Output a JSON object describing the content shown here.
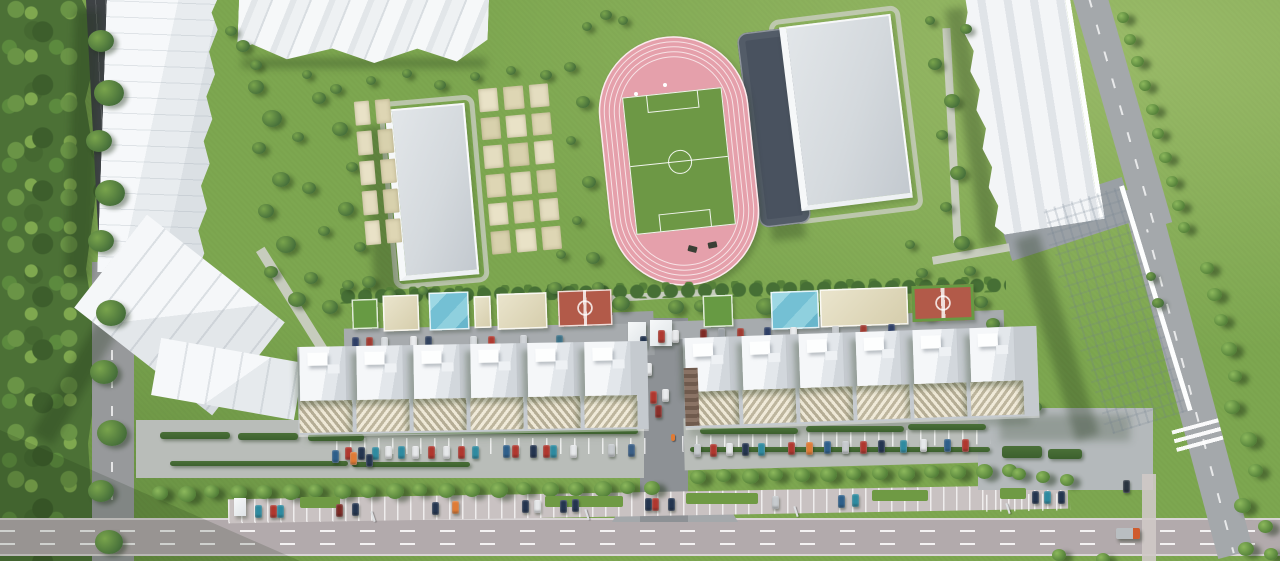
{
  "scene": {
    "width": 1280,
    "height": 561,
    "description": "Aerial 3D render of a residential complex masterplan: forest edge, apartment slabs, garden plots, school building, pink athletics stadium with soccer field, gray sports hall, courtyard playgrounds, tree-lined parking rows and roads"
  },
  "palette": {
    "lawn": "#7da750",
    "forest": "#4c7136",
    "roadDark": "#3e4245",
    "road": "#97999b",
    "roadMain": "#b2aaac",
    "roadLight": "#a4a8ab",
    "parkingLot": "#b9bdb9",
    "parkingStreet": "#c9c2c2",
    "path": "#cfd0ca",
    "building": "#f3f5f7",
    "slab": "#c5cacf",
    "track": "#e5a0ab",
    "field": "#6d9845",
    "darkCourt": "#49525f",
    "beige": "#e2dab8",
    "poolBlue": "#74c0d4",
    "redCourt": "#b25a49",
    "hedge": "#426834"
  },
  "sprites": {
    "courts": [
      [
        352,
        299,
        26,
        30,
        "c-green"
      ],
      [
        383,
        295,
        36,
        36,
        "c-beige"
      ],
      [
        429,
        292,
        40,
        38,
        "c-blue"
      ],
      [
        474,
        296,
        17,
        32,
        "c-beige"
      ],
      [
        497,
        293,
        50,
        36,
        "c-beige"
      ],
      [
        558,
        290,
        54,
        36,
        "c-red"
      ],
      [
        703,
        295,
        30,
        32,
        "c-green"
      ],
      [
        771,
        291,
        48,
        38,
        "c-blue"
      ],
      [
        820,
        288,
        88,
        38,
        "c-beige"
      ],
      [
        912,
        285,
        62,
        36,
        "c-red2"
      ]
    ],
    "gardens": [
      [
        483,
        84,
        74,
        170,
        -5,
        3,
        6
      ],
      [
        358,
        98,
        40,
        148,
        -5,
        2,
        5
      ]
    ],
    "midband": [
      [
        298,
        344,
        350,
        88,
        -1,
        6,
        57,
        46,
        0
      ],
      [
        684,
        332,
        354,
        90,
        -2,
        6,
        57,
        44,
        1
      ]
    ],
    "kiosks": [
      [
        628,
        322,
        18,
        24
      ],
      [
        650,
        320,
        22,
        26
      ],
      [
        234,
        498,
        12,
        18
      ]
    ],
    "hedges": [
      [
        160,
        432,
        70,
        7
      ],
      [
        238,
        433,
        60,
        7
      ],
      [
        308,
        434,
        56,
        7
      ],
      [
        170,
        461,
        178,
        5
      ],
      [
        352,
        462,
        118,
        5
      ],
      [
        700,
        428,
        98,
        6
      ],
      [
        806,
        426,
        98,
        6
      ],
      [
        908,
        424,
        78,
        6
      ],
      [
        690,
        447,
        300,
        5
      ],
      [
        312,
        429,
        326,
        5
      ],
      [
        1002,
        446,
        40,
        12
      ],
      [
        1048,
        449,
        34,
        10
      ]
    ],
    "medians": [
      [
        300,
        497,
        40,
        11
      ],
      [
        545,
        496,
        78,
        11
      ],
      [
        686,
        493,
        72,
        11
      ],
      [
        872,
        490,
        56,
        11
      ],
      [
        1000,
        488,
        26,
        11
      ]
    ],
    "trees": [
      [
        152,
        486,
        16
      ],
      [
        178,
        486,
        18
      ],
      [
        204,
        485,
        15
      ],
      [
        230,
        485,
        17
      ],
      [
        256,
        485,
        16
      ],
      [
        282,
        484,
        18
      ],
      [
        308,
        484,
        15
      ],
      [
        334,
        484,
        17
      ],
      [
        360,
        484,
        16
      ],
      [
        386,
        483,
        18
      ],
      [
        412,
        483,
        15
      ],
      [
        438,
        483,
        17
      ],
      [
        464,
        483,
        16
      ],
      [
        490,
        482,
        18
      ],
      [
        516,
        482,
        15
      ],
      [
        542,
        482,
        17
      ],
      [
        568,
        482,
        16
      ],
      [
        594,
        481,
        18
      ],
      [
        620,
        481,
        15
      ],
      [
        644,
        481,
        16
      ],
      [
        690,
        470,
        16
      ],
      [
        716,
        469,
        15
      ],
      [
        742,
        469,
        17
      ],
      [
        768,
        468,
        15
      ],
      [
        794,
        468,
        16
      ],
      [
        820,
        467,
        17
      ],
      [
        846,
        467,
        15
      ],
      [
        872,
        466,
        16
      ],
      [
        898,
        466,
        17
      ],
      [
        924,
        465,
        15
      ],
      [
        950,
        465,
        16
      ],
      [
        976,
        464,
        17
      ],
      [
        1002,
        464,
        15
      ],
      [
        1117,
        12,
        12
      ],
      [
        1124,
        34,
        12
      ],
      [
        1131,
        56,
        13
      ],
      [
        1139,
        80,
        12
      ],
      [
        1146,
        104,
        13
      ],
      [
        1152,
        128,
        12
      ],
      [
        1159,
        152,
        13
      ],
      [
        1166,
        176,
        12
      ],
      [
        1172,
        200,
        13
      ],
      [
        1178,
        222,
        12
      ],
      [
        1200,
        262,
        14
      ],
      [
        1207,
        288,
        15
      ],
      [
        1214,
        314,
        14
      ],
      [
        1221,
        342,
        16
      ],
      [
        1228,
        370,
        14
      ],
      [
        1224,
        400,
        16
      ],
      [
        1240,
        432,
        17
      ],
      [
        1248,
        464,
        15
      ],
      [
        1234,
        498,
        17
      ],
      [
        1258,
        520,
        15
      ],
      [
        1012,
        468,
        14
      ],
      [
        1036,
        471,
        14
      ],
      [
        1060,
        474,
        14
      ],
      [
        1052,
        549,
        14
      ],
      [
        1096,
        553,
        14
      ],
      [
        1238,
        542,
        16
      ],
      [
        1264,
        548,
        14
      ]
    ],
    "bushes": [
      [
        88,
        30,
        26
      ],
      [
        94,
        80,
        30
      ],
      [
        86,
        130,
        26
      ],
      [
        95,
        180,
        30
      ],
      [
        88,
        230,
        26
      ],
      [
        96,
        300,
        30
      ],
      [
        90,
        360,
        28
      ],
      [
        97,
        420,
        30
      ],
      [
        88,
        480,
        26
      ],
      [
        95,
        530,
        28
      ],
      [
        248,
        80,
        16
      ],
      [
        262,
        110,
        20
      ],
      [
        252,
        142,
        14
      ],
      [
        272,
        172,
        18
      ],
      [
        258,
        204,
        16
      ],
      [
        276,
        236,
        20
      ],
      [
        264,
        266,
        14
      ],
      [
        288,
        292,
        18
      ],
      [
        304,
        272,
        14
      ],
      [
        322,
        300,
        16
      ],
      [
        342,
        280,
        12
      ],
      [
        312,
        92,
        14
      ],
      [
        332,
        122,
        16
      ],
      [
        346,
        162,
        12
      ],
      [
        338,
        202,
        16
      ],
      [
        354,
        242,
        12
      ],
      [
        302,
        182,
        14
      ],
      [
        292,
        132,
        12
      ],
      [
        318,
        226,
        12
      ],
      [
        362,
        276,
        14
      ],
      [
        384,
        290,
        12
      ],
      [
        418,
        286,
        10
      ],
      [
        452,
        290,
        12
      ],
      [
        250,
        60,
        12
      ],
      [
        236,
        40,
        14
      ],
      [
        225,
        26,
        12
      ],
      [
        302,
        70,
        10
      ],
      [
        330,
        84,
        12
      ],
      [
        366,
        76,
        10
      ],
      [
        402,
        69,
        10
      ],
      [
        434,
        80,
        12
      ],
      [
        470,
        72,
        10
      ],
      [
        506,
        66,
        10
      ],
      [
        540,
        70,
        12
      ],
      [
        564,
        62,
        12
      ],
      [
        576,
        96,
        14
      ],
      [
        566,
        136,
        10
      ],
      [
        582,
        176,
        14
      ],
      [
        572,
        216,
        10
      ],
      [
        586,
        252,
        14
      ],
      [
        592,
        282,
        12
      ],
      [
        556,
        250,
        10
      ],
      [
        548,
        282,
        14
      ],
      [
        600,
        10,
        12
      ],
      [
        582,
        22,
        10
      ],
      [
        618,
        16,
        10
      ],
      [
        928,
        58,
        14
      ],
      [
        944,
        94,
        16
      ],
      [
        936,
        130,
        12
      ],
      [
        950,
        166,
        16
      ],
      [
        940,
        202,
        12
      ],
      [
        954,
        236,
        16
      ],
      [
        964,
        266,
        12
      ],
      [
        974,
        296,
        14
      ],
      [
        948,
        300,
        12
      ],
      [
        986,
        318,
        14
      ],
      [
        1002,
        330,
        12
      ],
      [
        932,
        286,
        10
      ],
      [
        922,
        310,
        12
      ],
      [
        960,
        24,
        12
      ],
      [
        925,
        16,
        10
      ],
      [
        905,
        240,
        10
      ],
      [
        916,
        268,
        12
      ],
      [
        1010,
        352,
        12
      ],
      [
        1022,
        378,
        10
      ],
      [
        1030,
        402,
        12
      ],
      [
        998,
        342,
        10
      ],
      [
        1146,
        272,
        10
      ],
      [
        1152,
        298,
        12
      ],
      [
        516,
        300,
        24
      ],
      [
        612,
        296,
        18
      ],
      [
        756,
        298,
        20
      ],
      [
        846,
        294,
        28
      ],
      [
        868,
        298,
        20
      ],
      [
        694,
        300,
        14
      ],
      [
        668,
        300,
        16
      ]
    ],
    "cars": [
      [
        352,
        337,
        "#2e3f66"
      ],
      [
        366,
        337,
        "#a03a31"
      ],
      [
        381,
        337,
        "#d8dcdf"
      ],
      [
        410,
        336,
        "#e9ebed"
      ],
      [
        425,
        336,
        "#31425f"
      ],
      [
        470,
        336,
        "#d8dcdf"
      ],
      [
        488,
        336,
        "#b03a31"
      ],
      [
        520,
        335,
        "#d0d4d8"
      ],
      [
        556,
        335,
        "#3a7086"
      ],
      [
        658,
        330,
        "#b03a31"
      ],
      [
        672,
        330,
        "#e9ebed"
      ],
      [
        700,
        329,
        "#7e2a24"
      ],
      [
        718,
        328,
        "#9aa0a6"
      ],
      [
        737,
        328,
        "#a03a31"
      ],
      [
        764,
        327,
        "#2e3f66"
      ],
      [
        790,
        327,
        "#e9ebed"
      ],
      [
        832,
        326,
        "#c7cbce"
      ],
      [
        860,
        325,
        "#a03a31"
      ],
      [
        888,
        324,
        "#2e3f66"
      ],
      [
        345,
        447,
        "#b0372e"
      ],
      [
        358,
        447,
        "#24354f"
      ],
      [
        372,
        447,
        "#2e8ba0"
      ],
      [
        385,
        446,
        "#e6e8ea"
      ],
      [
        398,
        446,
        "#2e8ba0"
      ],
      [
        412,
        446,
        "#e6e8ea"
      ],
      [
        428,
        446,
        "#b0372e"
      ],
      [
        443,
        446,
        "#e6e8ea"
      ],
      [
        458,
        446,
        "#b0372e"
      ],
      [
        472,
        446,
        "#2e8ba0"
      ],
      [
        503,
        445,
        "#2e5f8a"
      ],
      [
        512,
        445,
        "#b0372e"
      ],
      [
        530,
        445,
        "#24354f"
      ],
      [
        543,
        445,
        "#b0372e"
      ],
      [
        550,
        445,
        "#2e8ba0"
      ],
      [
        570,
        445,
        "#e6e8ea"
      ],
      [
        608,
        444,
        "#c7cbce"
      ],
      [
        628,
        444,
        "#3a5f86"
      ],
      [
        694,
        444,
        "#c7cbce"
      ],
      [
        710,
        444,
        "#b0372e"
      ],
      [
        726,
        443,
        "#e6e8ea"
      ],
      [
        742,
        443,
        "#24354f"
      ],
      [
        758,
        443,
        "#2e8ba0"
      ],
      [
        788,
        442,
        "#b0372e"
      ],
      [
        806,
        442,
        "#e07b35"
      ],
      [
        824,
        441,
        "#2e5f8a"
      ],
      [
        842,
        441,
        "#c7cbce"
      ],
      [
        860,
        441,
        "#b0372e"
      ],
      [
        878,
        440,
        "#24354f"
      ],
      [
        900,
        440,
        "#2e8ba0"
      ],
      [
        920,
        439,
        "#e6e8ea"
      ],
      [
        944,
        439,
        "#2e5f8a"
      ],
      [
        962,
        439,
        "#b0372e"
      ],
      [
        255,
        505,
        "#2e8ba0"
      ],
      [
        270,
        505,
        "#b0372e"
      ],
      [
        277,
        505,
        "#2e8ba0"
      ],
      [
        336,
        504,
        "#7b2a25"
      ],
      [
        352,
        503,
        "#24354f"
      ],
      [
        432,
        502,
        "#24354f"
      ],
      [
        452,
        501,
        "#e07b35"
      ],
      [
        522,
        500,
        "#24354f"
      ],
      [
        534,
        500,
        "#e6e8ea"
      ],
      [
        560,
        500,
        "#24354f"
      ],
      [
        572,
        499,
        "#24354f"
      ],
      [
        645,
        498,
        "#24354f"
      ],
      [
        652,
        498,
        "#b0372e"
      ],
      [
        668,
        498,
        "#24354f"
      ],
      [
        772,
        496,
        "#c7cbce"
      ],
      [
        838,
        495,
        "#2e5f8a"
      ],
      [
        852,
        494,
        "#2e8ba0"
      ],
      [
        1032,
        491,
        "#24354f"
      ],
      [
        1044,
        491,
        "#2e8ba0"
      ],
      [
        1058,
        491,
        "#24354f"
      ],
      [
        332,
        450,
        "#2e5f8a"
      ],
      [
        350,
        452,
        "#e07b35"
      ],
      [
        366,
        454,
        "#24354f"
      ],
      [
        640,
        336,
        "#24354f"
      ],
      [
        645,
        363,
        "#e9ebed"
      ],
      [
        650,
        391,
        "#b0372e"
      ],
      [
        655,
        405,
        "#8b2f2a"
      ],
      [
        662,
        389,
        "#e9ebed"
      ],
      [
        1123,
        480,
        "#2a3440"
      ]
    ],
    "dots": [
      [
        634,
        92
      ],
      [
        663,
        83
      ]
    ],
    "benches": [
      [
        688,
        246,
        15
      ],
      [
        708,
        242,
        -12
      ]
    ],
    "poles": [
      [
        372,
        511
      ],
      [
        586,
        509
      ],
      [
        795,
        506
      ],
      [
        1007,
        503
      ]
    ],
    "person": [
      [
        671,
        434
      ]
    ],
    "trucks": [
      [
        1116,
        528
      ]
    ]
  }
}
